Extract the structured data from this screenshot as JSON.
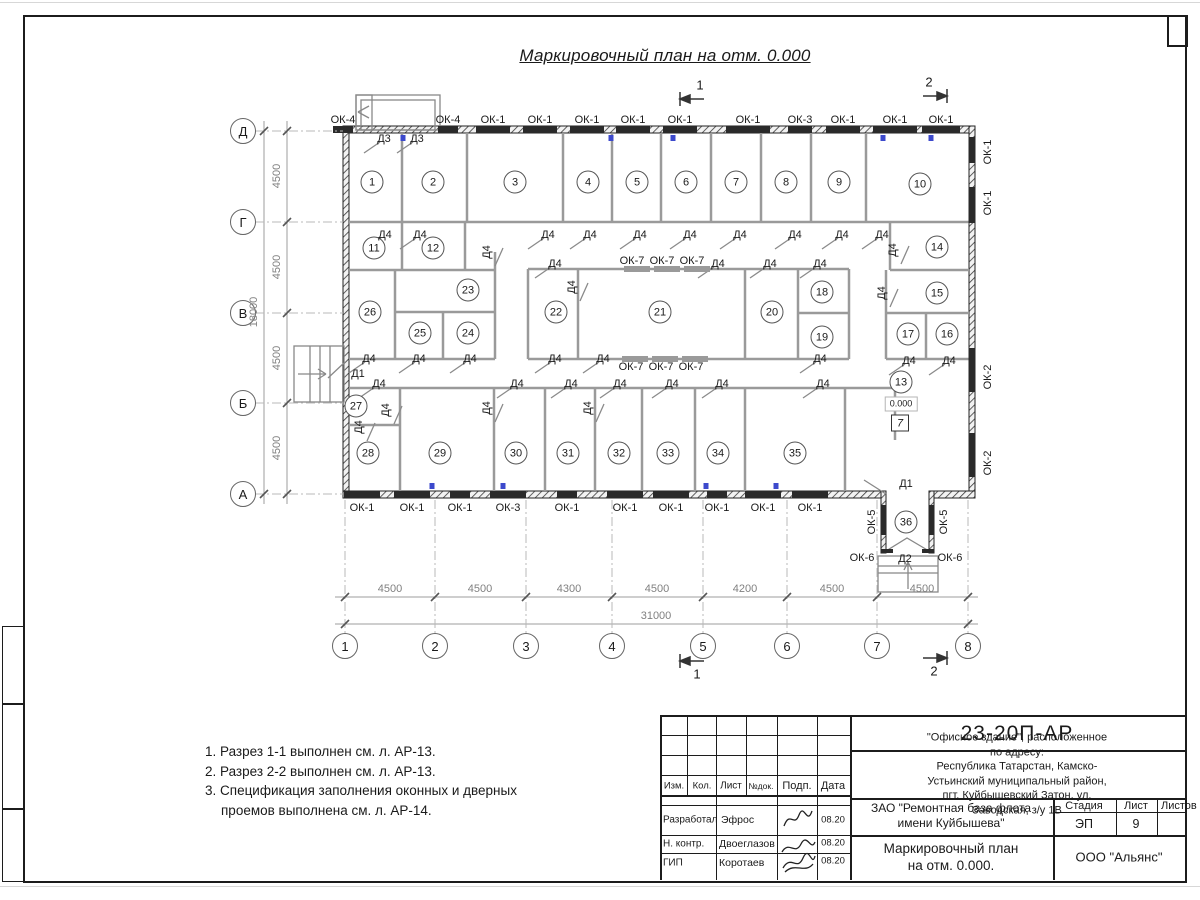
{
  "sheet": {
    "title": "Маркировочный план на отм. 0.000",
    "notes": [
      "1. Разрез 1-1 выполнен см. л. АР-13.",
      "2. Разрез 2-2 выполнен см. л. АР-13.",
      "3. Спецификация заполнения оконных и дверных",
      "проемов выполнена см. л. АР-14."
    ]
  },
  "plan": {
    "elevation": "0.000",
    "floor_mark": "7",
    "rooms": [
      {
        "n": "1",
        "x": 372,
        "y": 182
      },
      {
        "n": "2",
        "x": 433,
        "y": 182
      },
      {
        "n": "3",
        "x": 515,
        "y": 182
      },
      {
        "n": "4",
        "x": 588,
        "y": 182
      },
      {
        "n": "5",
        "x": 637,
        "y": 182
      },
      {
        "n": "6",
        "x": 686,
        "y": 182
      },
      {
        "n": "7",
        "x": 736,
        "y": 182
      },
      {
        "n": "8",
        "x": 786,
        "y": 182
      },
      {
        "n": "9",
        "x": 839,
        "y": 182
      },
      {
        "n": "10",
        "x": 920,
        "y": 184
      },
      {
        "n": "11",
        "x": 374,
        "y": 248
      },
      {
        "n": "12",
        "x": 433,
        "y": 248
      },
      {
        "n": "13",
        "x": 901,
        "y": 382
      },
      {
        "n": "14",
        "x": 937,
        "y": 247
      },
      {
        "n": "15",
        "x": 937,
        "y": 293
      },
      {
        "n": "16",
        "x": 947,
        "y": 334
      },
      {
        "n": "17",
        "x": 908,
        "y": 334
      },
      {
        "n": "18",
        "x": 822,
        "y": 292
      },
      {
        "n": "19",
        "x": 822,
        "y": 337
      },
      {
        "n": "20",
        "x": 772,
        "y": 312
      },
      {
        "n": "21",
        "x": 660,
        "y": 312
      },
      {
        "n": "22",
        "x": 556,
        "y": 312
      },
      {
        "n": "23",
        "x": 468,
        "y": 290
      },
      {
        "n": "24",
        "x": 468,
        "y": 333
      },
      {
        "n": "25",
        "x": 420,
        "y": 333
      },
      {
        "n": "26",
        "x": 370,
        "y": 312
      },
      {
        "n": "27",
        "x": 356,
        "y": 406
      },
      {
        "n": "28",
        "x": 368,
        "y": 453
      },
      {
        "n": "29",
        "x": 440,
        "y": 453
      },
      {
        "n": "30",
        "x": 516,
        "y": 453
      },
      {
        "n": "31",
        "x": 568,
        "y": 453
      },
      {
        "n": "32",
        "x": 619,
        "y": 453
      },
      {
        "n": "33",
        "x": 668,
        "y": 453
      },
      {
        "n": "34",
        "x": 718,
        "y": 453
      },
      {
        "n": "35",
        "x": 795,
        "y": 453
      },
      {
        "n": "36",
        "x": 906,
        "y": 522
      }
    ],
    "window_labels": [
      {
        "t": "ОК-4",
        "x": 343,
        "y": 120
      },
      {
        "t": "ОК-4",
        "x": 448,
        "y": 120
      },
      {
        "t": "ОК-1",
        "x": 493,
        "y": 120
      },
      {
        "t": "ОК-1",
        "x": 540,
        "y": 120
      },
      {
        "t": "ОК-1",
        "x": 587,
        "y": 120
      },
      {
        "t": "ОК-1",
        "x": 633,
        "y": 120
      },
      {
        "t": "ОК-1",
        "x": 680,
        "y": 120
      },
      {
        "t": "ОК-1",
        "x": 748,
        "y": 120
      },
      {
        "t": "ОК-3",
        "x": 800,
        "y": 120
      },
      {
        "t": "ОК-1",
        "x": 843,
        "y": 120
      },
      {
        "t": "ОК-1",
        "x": 895,
        "y": 120
      },
      {
        "t": "ОК-1",
        "x": 941,
        "y": 120
      },
      {
        "t": "ОК-1",
        "x": 362,
        "y": 508
      },
      {
        "t": "ОК-1",
        "x": 412,
        "y": 508
      },
      {
        "t": "ОК-1",
        "x": 460,
        "y": 508
      },
      {
        "t": "ОК-3",
        "x": 508,
        "y": 508
      },
      {
        "t": "ОК-1",
        "x": 567,
        "y": 508
      },
      {
        "t": "ОК-1",
        "x": 625,
        "y": 508
      },
      {
        "t": "ОК-1",
        "x": 671,
        "y": 508
      },
      {
        "t": "ОК-1",
        "x": 717,
        "y": 508
      },
      {
        "t": "ОК-1",
        "x": 763,
        "y": 508
      },
      {
        "t": "ОК-1",
        "x": 810,
        "y": 508
      },
      {
        "t": "ОК-1",
        "x": 988,
        "y": 152,
        "r": 1
      },
      {
        "t": "ОК-1",
        "x": 988,
        "y": 203,
        "r": 1
      },
      {
        "t": "ОК-2",
        "x": 988,
        "y": 377,
        "r": 1
      },
      {
        "t": "ОК-2",
        "x": 988,
        "y": 463,
        "r": 1
      },
      {
        "t": "ОК-5",
        "x": 872,
        "y": 522,
        "r": 1
      },
      {
        "t": "ОК-5",
        "x": 944,
        "y": 522,
        "r": 1
      },
      {
        "t": "ОК-6",
        "x": 862,
        "y": 558
      },
      {
        "t": "ОК-6",
        "x": 950,
        "y": 558
      },
      {
        "t": "ОК-7",
        "x": 632,
        "y": 261
      },
      {
        "t": "ОК-7",
        "x": 662,
        "y": 261
      },
      {
        "t": "ОК-7",
        "x": 692,
        "y": 261
      },
      {
        "t": "ОК-7",
        "x": 631,
        "y": 367
      },
      {
        "t": "ОК-7",
        "x": 661,
        "y": 367
      },
      {
        "t": "ОК-7",
        "x": 691,
        "y": 367
      }
    ],
    "door_labels": [
      {
        "t": "Д3",
        "x": 384,
        "y": 139
      },
      {
        "t": "Д3",
        "x": 417,
        "y": 139
      },
      {
        "t": "Д1",
        "x": 358,
        "y": 374,
        "noleaf": 1
      },
      {
        "t": "Д1",
        "x": 906,
        "y": 484,
        "noleaf": 1
      },
      {
        "t": "Д2",
        "x": 905,
        "y": 559,
        "noleaf": 1
      },
      {
        "t": "Д4",
        "x": 385,
        "y": 235
      },
      {
        "t": "Д4",
        "x": 420,
        "y": 235
      },
      {
        "t": "Д4",
        "x": 548,
        "y": 235
      },
      {
        "t": "Д4",
        "x": 590,
        "y": 235
      },
      {
        "t": "Д4",
        "x": 640,
        "y": 235
      },
      {
        "t": "Д4",
        "x": 690,
        "y": 235
      },
      {
        "t": "Д4",
        "x": 740,
        "y": 235
      },
      {
        "t": "Д4",
        "x": 795,
        "y": 235
      },
      {
        "t": "Д4",
        "x": 842,
        "y": 235
      },
      {
        "t": "Д4",
        "x": 882,
        "y": 235
      },
      {
        "t": "Д4",
        "x": 555,
        "y": 264
      },
      {
        "t": "Д4",
        "x": 718,
        "y": 264
      },
      {
        "t": "Д4",
        "x": 770,
        "y": 264
      },
      {
        "t": "Д4",
        "x": 820,
        "y": 264
      },
      {
        "t": "Д4",
        "x": 487,
        "y": 252,
        "r": 1
      },
      {
        "t": "Д4",
        "x": 572,
        "y": 287,
        "r": 1
      },
      {
        "t": "Д4",
        "x": 882,
        "y": 293,
        "r": 1
      },
      {
        "t": "Д4",
        "x": 893,
        "y": 250,
        "r": 1
      },
      {
        "t": "Д4",
        "x": 369,
        "y": 359
      },
      {
        "t": "Д4",
        "x": 419,
        "y": 359
      },
      {
        "t": "Д4",
        "x": 470,
        "y": 359
      },
      {
        "t": "Д4",
        "x": 555,
        "y": 359
      },
      {
        "t": "Д4",
        "x": 603,
        "y": 359
      },
      {
        "t": "Д4",
        "x": 820,
        "y": 359
      },
      {
        "t": "Д4",
        "x": 909,
        "y": 361
      },
      {
        "t": "Д4",
        "x": 949,
        "y": 361
      },
      {
        "t": "Д4",
        "x": 379,
        "y": 384
      },
      {
        "t": "Д4",
        "x": 517,
        "y": 384
      },
      {
        "t": "Д4",
        "x": 571,
        "y": 384
      },
      {
        "t": "Д4",
        "x": 620,
        "y": 384
      },
      {
        "t": "Д4",
        "x": 672,
        "y": 384
      },
      {
        "t": "Д4",
        "x": 722,
        "y": 384
      },
      {
        "t": "Д4",
        "x": 823,
        "y": 384
      },
      {
        "t": "Д4",
        "x": 386,
        "y": 410,
        "r": 1
      },
      {
        "t": "Д4",
        "x": 487,
        "y": 408,
        "r": 1
      },
      {
        "t": "Д4",
        "x": 588,
        "y": 408,
        "r": 1
      },
      {
        "t": "Д4",
        "x": 359,
        "y": 427,
        "r": 1
      }
    ],
    "window_marks": {
      "top": [
        {
          "x": 343,
          "w": 20
        },
        {
          "x": 448,
          "w": 20
        },
        {
          "x": 493,
          "w": 34
        },
        {
          "x": 540,
          "w": 34
        },
        {
          "x": 587,
          "w": 34
        },
        {
          "x": 633,
          "w": 34
        },
        {
          "x": 680,
          "w": 34
        },
        {
          "x": 748,
          "w": 44
        },
        {
          "x": 800,
          "w": 24
        },
        {
          "x": 843,
          "w": 34
        },
        {
          "x": 895,
          "w": 44
        },
        {
          "x": 941,
          "w": 38
        }
      ],
      "bottom": [
        {
          "x": 362,
          "w": 36
        },
        {
          "x": 412,
          "w": 36
        },
        {
          "x": 460,
          "w": 20
        },
        {
          "x": 508,
          "w": 36
        },
        {
          "x": 567,
          "w": 20
        },
        {
          "x": 625,
          "w": 36
        },
        {
          "x": 671,
          "w": 36
        },
        {
          "x": 717,
          "w": 20
        },
        {
          "x": 763,
          "w": 36
        },
        {
          "x": 810,
          "w": 36
        }
      ],
      "right": [
        {
          "y": 150,
          "h": 26
        },
        {
          "y": 205,
          "h": 36
        },
        {
          "y": 370,
          "h": 44
        },
        {
          "y": 455,
          "h": 44
        }
      ],
      "corridor": [
        {
          "x": 637
        },
        {
          "x": 667
        },
        {
          "x": 697
        },
        {
          "x": 635,
          "b": 1
        },
        {
          "x": 665,
          "b": 1
        },
        {
          "x": 695,
          "b": 1
        }
      ]
    },
    "vent_marks": [
      {
        "x": 403,
        "y": 135
      },
      {
        "x": 611,
        "y": 135
      },
      {
        "x": 673,
        "y": 135
      },
      {
        "x": 883,
        "y": 135
      },
      {
        "x": 931,
        "y": 135
      },
      {
        "x": 432,
        "y": 483
      },
      {
        "x": 503,
        "y": 483
      },
      {
        "x": 706,
        "y": 483
      },
      {
        "x": 776,
        "y": 483
      }
    ]
  },
  "grid": {
    "cols": [
      {
        "label": "1",
        "x": 345
      },
      {
        "label": "2",
        "x": 435
      },
      {
        "label": "3",
        "x": 526
      },
      {
        "label": "4",
        "x": 612
      },
      {
        "label": "5",
        "x": 703
      },
      {
        "label": "6",
        "x": 787
      },
      {
        "label": "7",
        "x": 877
      },
      {
        "label": "8",
        "x": 968
      }
    ],
    "rows": [
      {
        "label": "Д",
        "y": 131
      },
      {
        "label": "Г",
        "y": 222
      },
      {
        "label": "В",
        "y": 313
      },
      {
        "label": "Б",
        "y": 403
      },
      {
        "label": "А",
        "y": 494
      }
    ]
  },
  "dims": {
    "h": [
      {
        "v": "4500",
        "x": 390
      },
      {
        "v": "4500",
        "x": 480
      },
      {
        "v": "4300",
        "x": 569
      },
      {
        "v": "4500",
        "x": 657
      },
      {
        "v": "4200",
        "x": 745
      },
      {
        "v": "4500",
        "x": 832
      },
      {
        "v": "4500",
        "x": 922
      }
    ],
    "h_total": "31000",
    "v": [
      {
        "v": "4500",
        "y": 176
      },
      {
        "v": "4500",
        "y": 267
      },
      {
        "v": "4500",
        "y": 358
      },
      {
        "v": "4500",
        "y": 448
      }
    ],
    "v_total": "18000"
  },
  "sections": [
    "1",
    "2",
    "1",
    "2"
  ],
  "titleblock": {
    "doc_number": "23-20П-АР",
    "object_lines": [
      "\"Офисное здание\", расположенное по адресу:",
      "Республика Татарстан, Камско-Устьинский муниципальный район,",
      "пгт. Куйбышевский Затон, ул. Заводская, з/у 1В"
    ],
    "cols": {
      "c1": "Изм.",
      "c2": "Кол.",
      "c3": "Лист",
      "c4": "№док.",
      "c5": "Подп.",
      "c6": "Дата"
    },
    "roles": [
      {
        "role": "Разработал",
        "name": "Эфрос",
        "date": "08.20"
      },
      {
        "role": "Н. контр.",
        "name": "Двоеглазов",
        "date": "08.20"
      },
      {
        "role": "ГИП",
        "name": "Коротаев",
        "date": "08.20"
      }
    ],
    "client_lines": [
      "ЗАО \"Ремонтная база флота",
      "имени Куйбышева\""
    ],
    "stage_label": "Стадия",
    "sheet_label": "Лист",
    "sheets_label": "Листов",
    "stage": "ЭП",
    "sheet_no": "9",
    "sheet_title_lines": [
      "Маркировочный план",
      "на отм. 0.000."
    ],
    "company": "ООО \"Альянс\""
  }
}
